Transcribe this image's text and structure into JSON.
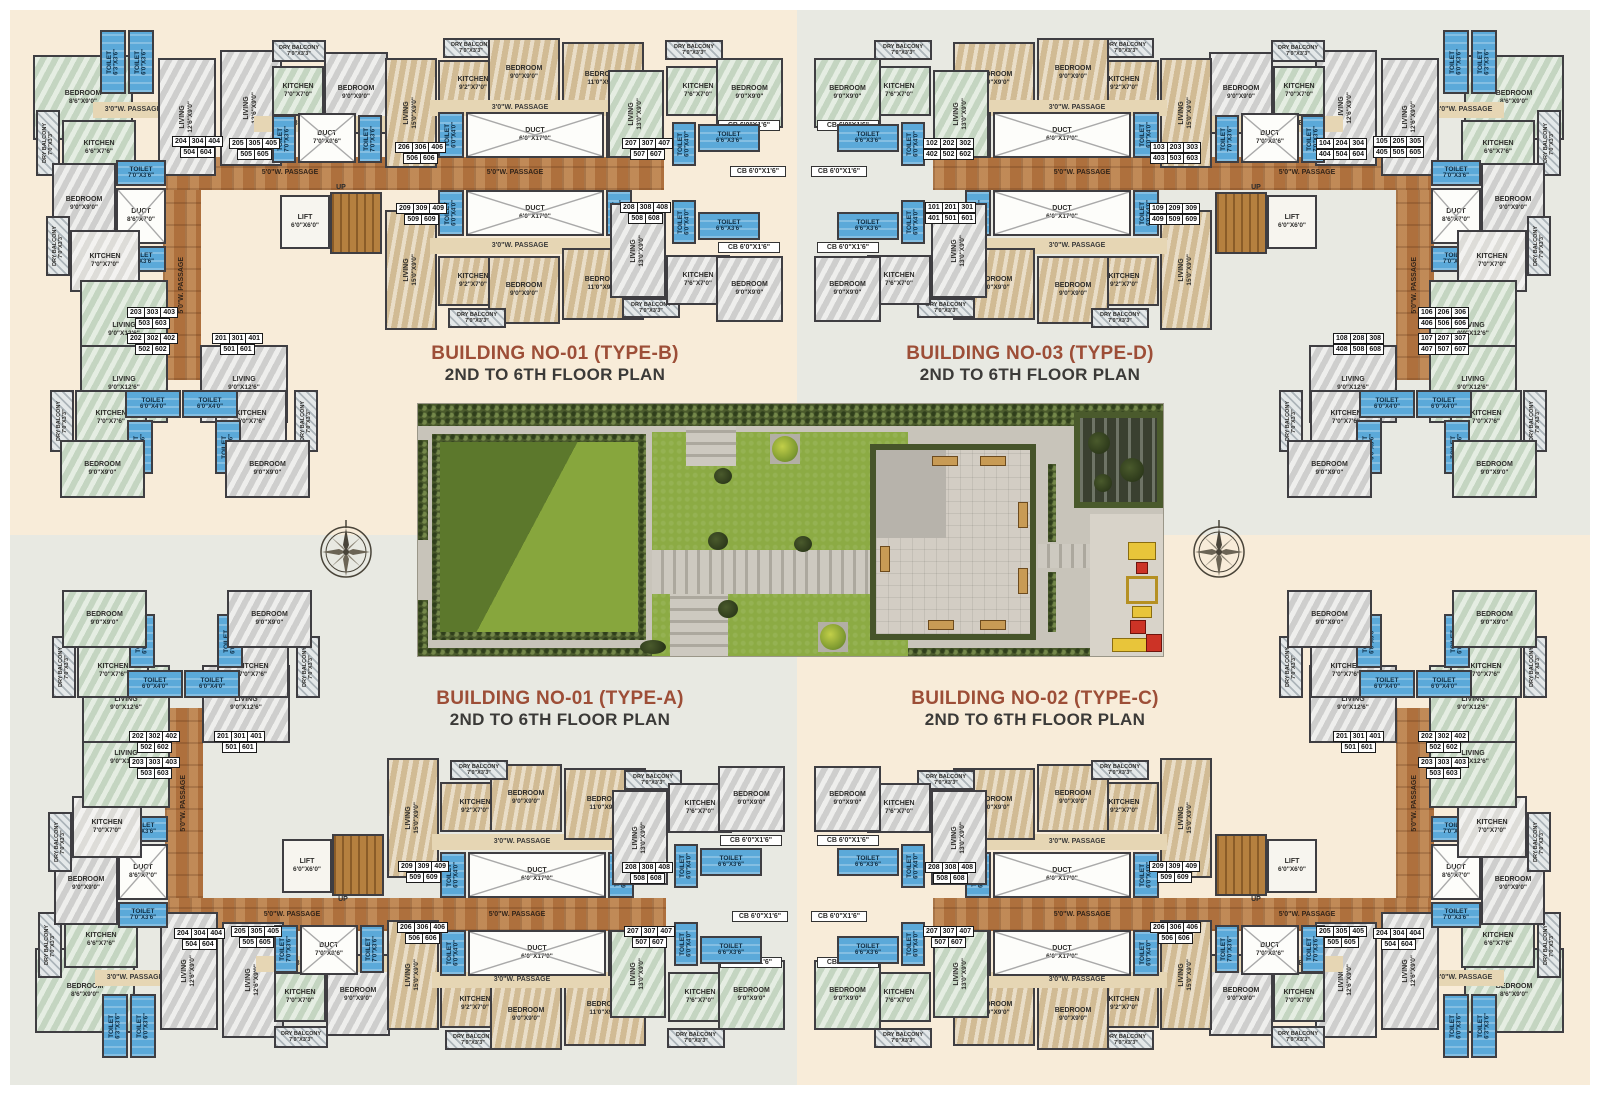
{
  "colors": {
    "page_border": "#ffffff",
    "quad_cream": "#f8ecd9",
    "quad_gray": "#e8e9e2",
    "title_accent": "#9d4e37",
    "subtitle": "#3b3a38",
    "wall": "#3f3e42",
    "passage_brown": "#b87c46",
    "toilet_blue": "#5ba9d9",
    "lawn_green": "#8cab44",
    "hedge_green": "#4a5a2c"
  },
  "titles": [
    {
      "line1": "BUILDING NO-01 (TYPE-B)",
      "line2": "2ND TO 6TH FLOOR PLAN"
    },
    {
      "line1": "BUILDING NO-03 (TYPE-D)",
      "line2": "2ND TO 6TH FLOOR PLAN"
    },
    {
      "line1": "BUILDING NO-01 (TYPE-A)",
      "line2": "2ND TO 6TH FLOOR PLAN"
    },
    {
      "line1": "BUILDING NO-02 (TYPE-C)",
      "line2": "2ND TO 6TH FLOOR PLAN"
    }
  ],
  "room_template": [
    {
      "x": 3,
      "y": 37,
      "w": 100,
      "h": 85,
      "c": "mGn",
      "t": "BEDROOM",
      "d": "8'6\"X9'0\""
    },
    {
      "x": 70,
      "y": 12,
      "w": 26,
      "h": 64,
      "c": "toi",
      "t": "TOILET",
      "d": "6'3\"X3'6\"",
      "v": true
    },
    {
      "x": 98,
      "y": 12,
      "w": 26,
      "h": 64,
      "c": "toi",
      "t": "TOILET",
      "d": "6'0\"X3'6\"",
      "v": true
    },
    {
      "x": 63,
      "y": 84,
      "w": 80,
      "h": 16,
      "c": "p3",
      "t": "3'0\"W. PASSAGE"
    },
    {
      "x": 6,
      "y": 92,
      "w": 24,
      "h": 66,
      "c": "bal",
      "t": "DRY BALCONY",
      "d": "7'0\"X3'3\"",
      "v": true
    },
    {
      "x": 32,
      "y": 102,
      "w": 74,
      "h": 56,
      "c": "mGn",
      "t": "KITCHEN",
      "d": "6'6\"X7'6\""
    },
    {
      "x": 128,
      "y": 40,
      "w": 58,
      "h": 118,
      "c": "mGr",
      "t": "LIVING",
      "d": "12'6\"X9'0\"",
      "v": true
    },
    {
      "x": 190,
      "y": 32,
      "w": 62,
      "h": 116,
      "c": "mGr",
      "t": "LIVING",
      "d": "12'6\"X9'0\"",
      "v": true
    },
    {
      "x": 242,
      "y": 22,
      "w": 54,
      "h": 22,
      "c": "bal",
      "t": "DRY BALCONY",
      "d": "7'0\"X3'3\""
    },
    {
      "x": 242,
      "y": 48,
      "w": 52,
      "h": 50,
      "c": "mGn",
      "t": "KITCHEN",
      "d": "7'0\"X7'0\""
    },
    {
      "x": 294,
      "y": 34,
      "w": 64,
      "h": 82,
      "c": "mGr",
      "t": "BEDROOM",
      "d": "9'0\"X9'0\""
    },
    {
      "x": 224,
      "y": 98,
      "w": 136,
      "h": 16,
      "c": "p3",
      "t": "3'0\"W. PASSAGE"
    },
    {
      "x": 242,
      "y": 97,
      "w": 24,
      "h": 48,
      "c": "toi",
      "t": "TOILET",
      "d": "7'0\"X3'6\"",
      "v": true
    },
    {
      "x": 268,
      "y": 95,
      "w": 58,
      "h": 50,
      "c": "duct",
      "t": "DUCT",
      "d": "7'0\"X8'6\""
    },
    {
      "x": 328,
      "y": 97,
      "w": 24,
      "h": 48,
      "c": "toi",
      "t": "TOILET",
      "d": "7'0\"X3'6\"",
      "v": true
    },
    {
      "x": 355,
      "y": 40,
      "w": 52,
      "h": 110,
      "c": "mT",
      "t": "LIVING",
      "d": "15'0\"X9'0\"",
      "v": true
    },
    {
      "x": 413,
      "y": 20,
      "w": 56,
      "h": 20,
      "c": "bal",
      "t": "DRY BALCONY",
      "d": "7'0\"X3'3\""
    },
    {
      "x": 408,
      "y": 42,
      "w": 70,
      "h": 48,
      "c": "mT",
      "t": "KITCHEN",
      "d": "9'2\"X7'0\""
    },
    {
      "x": 458,
      "y": 20,
      "w": 72,
      "h": 70,
      "c": "mT",
      "t": "BEDROOM",
      "d": "9'0\"X9'0\""
    },
    {
      "x": 532,
      "y": 24,
      "w": 82,
      "h": 74,
      "c": "mT",
      "t": "BEDROOM",
      "d": "11'0\"X9'0\""
    },
    {
      "x": 400,
      "y": 82,
      "w": 180,
      "h": 16,
      "c": "p3",
      "t": "3'0\"W. PASSAGE"
    },
    {
      "x": 408,
      "y": 94,
      "w": 26,
      "h": 46,
      "c": "toi",
      "t": "TOILET",
      "d": "6'0\"X4'0\"",
      "v": true
    },
    {
      "x": 436,
      "y": 94,
      "w": 138,
      "h": 46,
      "c": "duct",
      "t": "DUCT",
      "d": "6'0\"X17'0\""
    },
    {
      "x": 576,
      "y": 94,
      "w": 26,
      "h": 46,
      "c": "toi",
      "t": "TOILET",
      "d": "6'0\"X4'0\"",
      "v": true
    },
    {
      "x": 578,
      "y": 52,
      "w": 56,
      "h": 88,
      "c": "mGn",
      "t": "LIVING",
      "d": "13'0\"X9'0\"",
      "v": true
    },
    {
      "x": 635,
      "y": 22,
      "w": 58,
      "h": 20,
      "c": "bal",
      "t": "DRY BALCONY",
      "d": "7'0\"X3'3\""
    },
    {
      "x": 636,
      "y": 48,
      "w": 64,
      "h": 50,
      "c": "mGn",
      "t": "KITCHEN",
      "d": "7'6\"X7'0\""
    },
    {
      "x": 686,
      "y": 40,
      "w": 67,
      "h": 70,
      "c": "mGn",
      "t": "BEDROOM",
      "d": "9'0\"X9'0\""
    },
    {
      "x": 688,
      "y": 102,
      "w": 62,
      "h": 11,
      "c": "cbl",
      "t": "CB 6'0\"X1'6\""
    },
    {
      "x": 642,
      "y": 104,
      "w": 24,
      "h": 44,
      "c": "toi",
      "t": "TOILET",
      "d": "6'0\"X4'0\"",
      "v": true
    },
    {
      "x": 668,
      "y": 106,
      "w": 62,
      "h": 28,
      "c": "toi",
      "t": "TOILET",
      "d": "6'6\"X3'6\""
    },
    {
      "x": 136,
      "y": 139,
      "w": 498,
      "h": 33,
      "c": "pass5",
      "t": ""
    },
    {
      "x": 200,
      "y": 148,
      "w": 120,
      "h": 14,
      "c": "plabel",
      "t": "5'0\"W. PASSAGE"
    },
    {
      "x": 425,
      "y": 148,
      "w": 120,
      "h": 14,
      "c": "plabel",
      "t": "5'0\"W. PASSAGE"
    },
    {
      "x": 133,
      "y": 172,
      "w": 38,
      "h": 190,
      "c": "pass5",
      "t": "5'0\"W. PASSAGE",
      "v": true
    },
    {
      "x": 86,
      "y": 142,
      "w": 50,
      "h": 26,
      "c": "toi",
      "t": "TOILET",
      "d": "7'0\"X3'6\""
    },
    {
      "x": 86,
      "y": 170,
      "w": 50,
      "h": 56,
      "c": "duct",
      "t": "DUCT",
      "d": "8'6\"X7'0\""
    },
    {
      "x": 86,
      "y": 228,
      "w": 50,
      "h": 26,
      "c": "toi",
      "t": "TOILET",
      "d": "7'0\"X3'6\""
    },
    {
      "x": 22,
      "y": 145,
      "w": 64,
      "h": 82,
      "c": "mGr",
      "t": "BEDROOM",
      "d": "9'0\"X9'0\""
    },
    {
      "x": 16,
      "y": 198,
      "w": 24,
      "h": 60,
      "c": "bal",
      "t": "DRY BALCONY",
      "d": "7'0\"X3'3\"",
      "v": true
    },
    {
      "x": 40,
      "y": 212,
      "w": 70,
      "h": 62,
      "c": "mW",
      "t": "KITCHEN",
      "d": "7'0\"X7'0\""
    },
    {
      "x": 50,
      "y": 262,
      "w": 88,
      "h": 100,
      "c": "mGn",
      "t": "LIVING",
      "d": "9'0\"X12'6\""
    },
    {
      "x": 50,
      "y": 327,
      "w": 88,
      "h": 78,
      "c": "mGn",
      "t": "LIVING",
      "d": "9'0\"X12'6\""
    },
    {
      "x": 170,
      "y": 327,
      "w": 88,
      "h": 78,
      "c": "mGr",
      "t": "LIVING",
      "d": "9'0\"X12'6\""
    },
    {
      "x": 45,
      "y": 372,
      "w": 72,
      "h": 55,
      "c": "mGn",
      "t": "KITCHEN",
      "d": "7'0\"X7'6\""
    },
    {
      "x": 185,
      "y": 372,
      "w": 72,
      "h": 55,
      "c": "mGr",
      "t": "KITCHEN",
      "d": "7'0\"X7'6\""
    },
    {
      "x": 95,
      "y": 372,
      "w": 56,
      "h": 28,
      "c": "toi",
      "t": "TOILET",
      "d": "6'0\"X4'0\""
    },
    {
      "x": 152,
      "y": 372,
      "w": 56,
      "h": 28,
      "c": "toi",
      "t": "TOILET",
      "d": "6'0\"X4'0\""
    },
    {
      "x": 97,
      "y": 402,
      "w": 26,
      "h": 54,
      "c": "toi",
      "t": "TOILET",
      "d": "6'0\"X3'6\"",
      "v": true
    },
    {
      "x": 185,
      "y": 402,
      "w": 26,
      "h": 54,
      "c": "toi",
      "t": "TOILET",
      "d": "6'0\"X3'6\"",
      "v": true
    },
    {
      "x": 20,
      "y": 372,
      "w": 24,
      "h": 62,
      "c": "bal",
      "t": "DRY BALCONY",
      "d": "7'0\"X3'3\"",
      "v": true
    },
    {
      "x": 264,
      "y": 372,
      "w": 24,
      "h": 62,
      "c": "bal",
      "t": "DRY BALCONY",
      "d": "7'0\"X3'3\"",
      "v": true
    },
    {
      "x": 30,
      "y": 422,
      "w": 85,
      "h": 58,
      "c": "mGn",
      "t": "BEDROOM",
      "d": "9'0\"X9'0\""
    },
    {
      "x": 195,
      "y": 422,
      "w": 85,
      "h": 58,
      "c": "mGr",
      "t": "BEDROOM",
      "d": "9'0\"X9'0\""
    },
    {
      "x": 250,
      "y": 177,
      "w": 50,
      "h": 54,
      "c": "lift",
      "t": "LIFT",
      "d": "6'0\"X6'0\""
    },
    {
      "x": 300,
      "y": 174,
      "w": 52,
      "h": 62,
      "c": "stairs",
      "t": ""
    },
    {
      "x": 296,
      "y": 165,
      "w": 30,
      "h": 10,
      "c": "upl",
      "t": "UP"
    },
    {
      "x": 355,
      "y": 192,
      "w": 52,
      "h": 120,
      "c": "mT",
      "t": "LIVING",
      "d": "15'0\"X9'0\"",
      "v": true
    },
    {
      "x": 408,
      "y": 172,
      "w": 26,
      "h": 46,
      "c": "toi",
      "t": "TOILET",
      "d": "6'0\"X4'0\"",
      "v": true
    },
    {
      "x": 436,
      "y": 172,
      "w": 138,
      "h": 46,
      "c": "duct",
      "t": "DUCT",
      "d": "6'0\"X17'0\""
    },
    {
      "x": 576,
      "y": 172,
      "w": 26,
      "h": 46,
      "c": "toi",
      "t": "TOILET",
      "d": "6'0\"X4'0\"",
      "v": true
    },
    {
      "x": 400,
      "y": 220,
      "w": 180,
      "h": 16,
      "c": "p3",
      "t": "3'0\"W. PASSAGE"
    },
    {
      "x": 408,
      "y": 238,
      "w": 70,
      "h": 50,
      "c": "mT",
      "t": "KITCHEN",
      "d": "9'2\"X7'0\""
    },
    {
      "x": 458,
      "y": 238,
      "w": 72,
      "h": 68,
      "c": "mT",
      "t": "BEDROOM",
      "d": "9'0\"X9'0\""
    },
    {
      "x": 532,
      "y": 230,
      "w": 82,
      "h": 72,
      "c": "mT",
      "t": "BEDROOM",
      "d": "11'0\"X9'0\""
    },
    {
      "x": 418,
      "y": 290,
      "w": 58,
      "h": 20,
      "c": "bal",
      "t": "DRY BALCONY",
      "d": "7'0\"X3'3\""
    },
    {
      "x": 592,
      "y": 280,
      "w": 58,
      "h": 20,
      "c": "bal",
      "t": "DRY BALCONY",
      "d": "7'0\"X3'3\""
    },
    {
      "x": 580,
      "y": 185,
      "w": 56,
      "h": 95,
      "c": "mGr",
      "t": "LIVING",
      "d": "13'0\"X9'0\"",
      "v": true
    },
    {
      "x": 642,
      "y": 182,
      "w": 24,
      "h": 44,
      "c": "toi",
      "t": "TOILET",
      "d": "6'0\"X4'0\"",
      "v": true
    },
    {
      "x": 668,
      "y": 194,
      "w": 62,
      "h": 28,
      "c": "toi",
      "t": "TOILET",
      "d": "6'6\"X3'6\""
    },
    {
      "x": 688,
      "y": 224,
      "w": 62,
      "h": 11,
      "c": "cbl",
      "t": "CB 6'0\"X1'6\""
    },
    {
      "x": 700,
      "y": 148,
      "w": 56,
      "h": 11,
      "c": "cbl",
      "t": "CB 6'0\"X1'6\""
    },
    {
      "x": 636,
      "y": 237,
      "w": 64,
      "h": 50,
      "c": "mGr",
      "t": "KITCHEN",
      "d": "7'6\"X7'0\""
    },
    {
      "x": 686,
      "y": 238,
      "w": 67,
      "h": 66,
      "c": "mGr",
      "t": "BEDROOM",
      "d": "9'0\"X9'0\""
    }
  ],
  "chip_slots": [
    {
      "id": "s1",
      "x": 175,
      "y": 315
    },
    {
      "id": "s2",
      "x": 90,
      "y": 315
    },
    {
      "id": "s3",
      "x": 90,
      "y": 289
    },
    {
      "id": "s4",
      "x": 135,
      "y": 118
    },
    {
      "id": "s5",
      "x": 192,
      "y": 120
    },
    {
      "id": "s6",
      "x": 358,
      "y": 124
    },
    {
      "id": "s7",
      "x": 585,
      "y": 120
    },
    {
      "id": "s8",
      "x": 583,
      "y": 184
    },
    {
      "id": "s9",
      "x": 359,
      "y": 185
    }
  ],
  "buildings": [
    {
      "name": "building-01-type-b",
      "ox": 30,
      "oy": 18,
      "mx": false,
      "my": false,
      "chips": {
        "s1": [
          "201|301|401",
          "501|601"
        ],
        "s2": [
          "202|302|402",
          "502|602"
        ],
        "s3": [
          "203|303|403",
          "503|603"
        ],
        "s4": [
          "204|304|404",
          "504|604"
        ],
        "s5": [
          "205|305|405",
          "505|605"
        ],
        "s6": [
          "206|306|406",
          "506|606"
        ],
        "s7": [
          "207|307|407",
          "507|607"
        ],
        "s8": [
          "208|308|408",
          "508|608"
        ],
        "s9": [
          "209|309|409",
          "509|609"
        ]
      }
    },
    {
      "name": "building-03-type-d",
      "ox": 812,
      "oy": 18,
      "mx": true,
      "my": false,
      "chips": {
        "s1": [
          "108|208|308",
          "408|508|608"
        ],
        "s2": [
          "107|207|307",
          "407|507|607"
        ],
        "s3": [
          "106|206|306",
          "406|506|606"
        ],
        "s4": [
          "105|205|305",
          "405|505|605"
        ],
        "s5": [
          "104|204|304",
          "404|504|604"
        ],
        "s6": [
          "103|203|303",
          "403|503|603"
        ],
        "s7": [
          "102|202|302",
          "402|502|602"
        ],
        "s8": [
          "101|201|301",
          "401|501|601"
        ],
        "s9": [
          "109|209|309",
          "409|509|609"
        ]
      }
    },
    {
      "name": "building-01-type-a",
      "ox": 32,
      "oy": 588,
      "mx": false,
      "my": true,
      "chips": {
        "s1": [
          "201|301|401",
          "501|601"
        ],
        "s2": [
          "202|302|402",
          "502|602"
        ],
        "s3": [
          "203|303|403",
          "503|603"
        ],
        "s4": [
          "204|304|404",
          "504|604"
        ],
        "s5": [
          "205|305|405",
          "505|605"
        ],
        "s6": [
          "206|306|406",
          "506|606"
        ],
        "s7": [
          "207|307|407",
          "507|607"
        ],
        "s8": [
          "208|308|408",
          "508|608"
        ],
        "s9": [
          "209|309|409",
          "509|609"
        ]
      }
    },
    {
      "name": "building-02-type-c",
      "ox": 812,
      "oy": 588,
      "mx": true,
      "my": true,
      "chips": {
        "s1": [
          "201|301|401",
          "501|601"
        ],
        "s2": [
          "202|302|402",
          "502|602"
        ],
        "s3": [
          "203|303|403",
          "503|603"
        ],
        "s4": [
          "204|304|404",
          "504|604"
        ],
        "s5": [
          "205|305|405",
          "505|605"
        ],
        "s6": [
          "206|306|406",
          "506|606"
        ],
        "s7": [
          "207|307|407",
          "507|607"
        ],
        "s8": [
          "208|308|408",
          "508|608"
        ],
        "s9": [
          "209|309|409",
          "509|609"
        ]
      }
    }
  ]
}
